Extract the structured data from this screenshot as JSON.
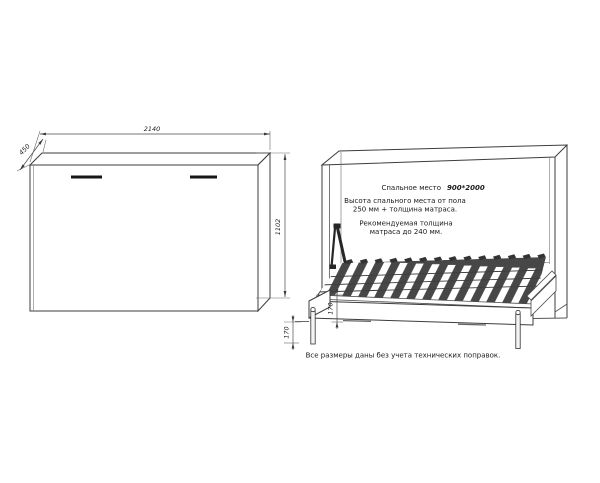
{
  "page": {
    "background": "#ffffff",
    "line_color": "#3c3c3c",
    "slat_dark": "#474747"
  },
  "views": {
    "closed": {
      "title": "closed wall-bed front view",
      "dims": {
        "width": "2140",
        "depth": "450",
        "height": "1102"
      }
    },
    "open": {
      "title": "open wall-bed perspective view",
      "dims": {
        "frame_height": "170",
        "floor_clearance": "170"
      },
      "annotations": {
        "sleeping_label": "Спальное место",
        "sleeping_value": "900*2000",
        "height_line1": "Высота спального места от пола",
        "height_line2": "250 мм + толщина матраса.",
        "mattress_line1": "Рекомендуемая толщина",
        "mattress_line2": "матраса до 240 мм."
      }
    }
  },
  "footer": {
    "note": "Все размеры даны без учета технических поправок."
  }
}
